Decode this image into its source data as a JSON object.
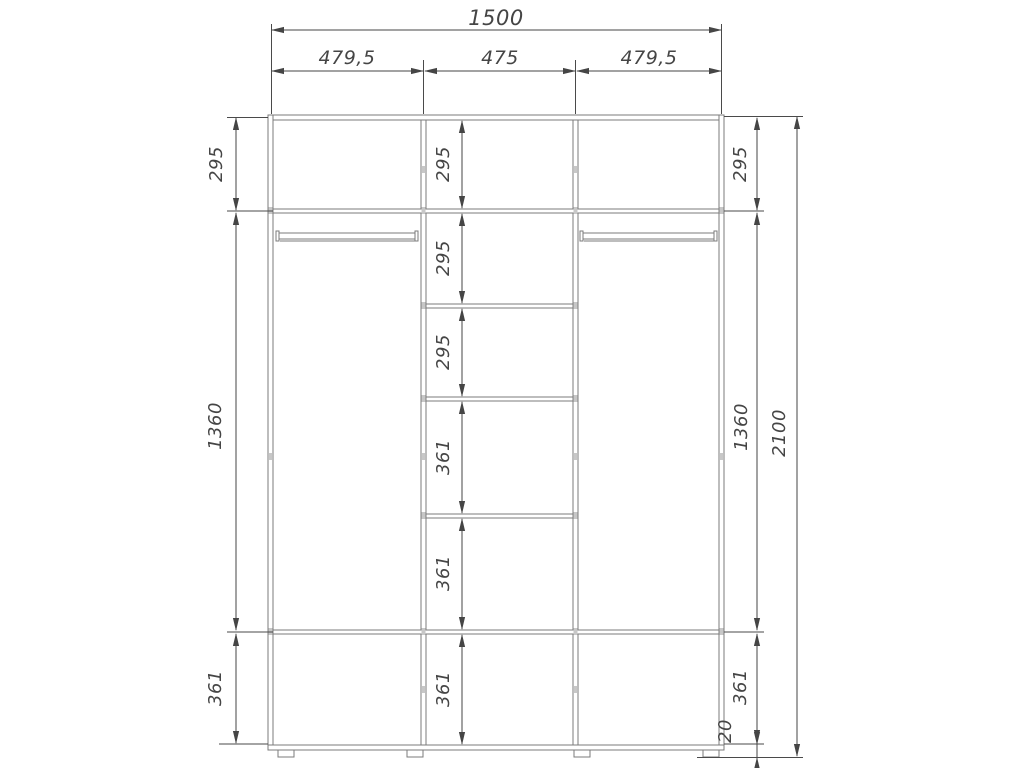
{
  "drawing": {
    "kind": "wardrobe-dimension-drawing",
    "dimensions": {
      "total_width": "1500",
      "section_widths": [
        "479,5",
        "475",
        "479,5"
      ],
      "left_column_heights": [
        "295",
        "1360",
        "361"
      ],
      "center_column_heights": [
        "295",
        "295",
        "295",
        "361",
        "361",
        "361"
      ],
      "right_column_heights": [
        "295",
        "1360",
        "361"
      ],
      "plinth_height": "20",
      "total_height": "2100"
    },
    "colors": {
      "background": "#ffffff",
      "cabinet_line": "#7b7b7b",
      "dimension_line": "#454545",
      "joint_mark": "#c7c7c7"
    }
  }
}
